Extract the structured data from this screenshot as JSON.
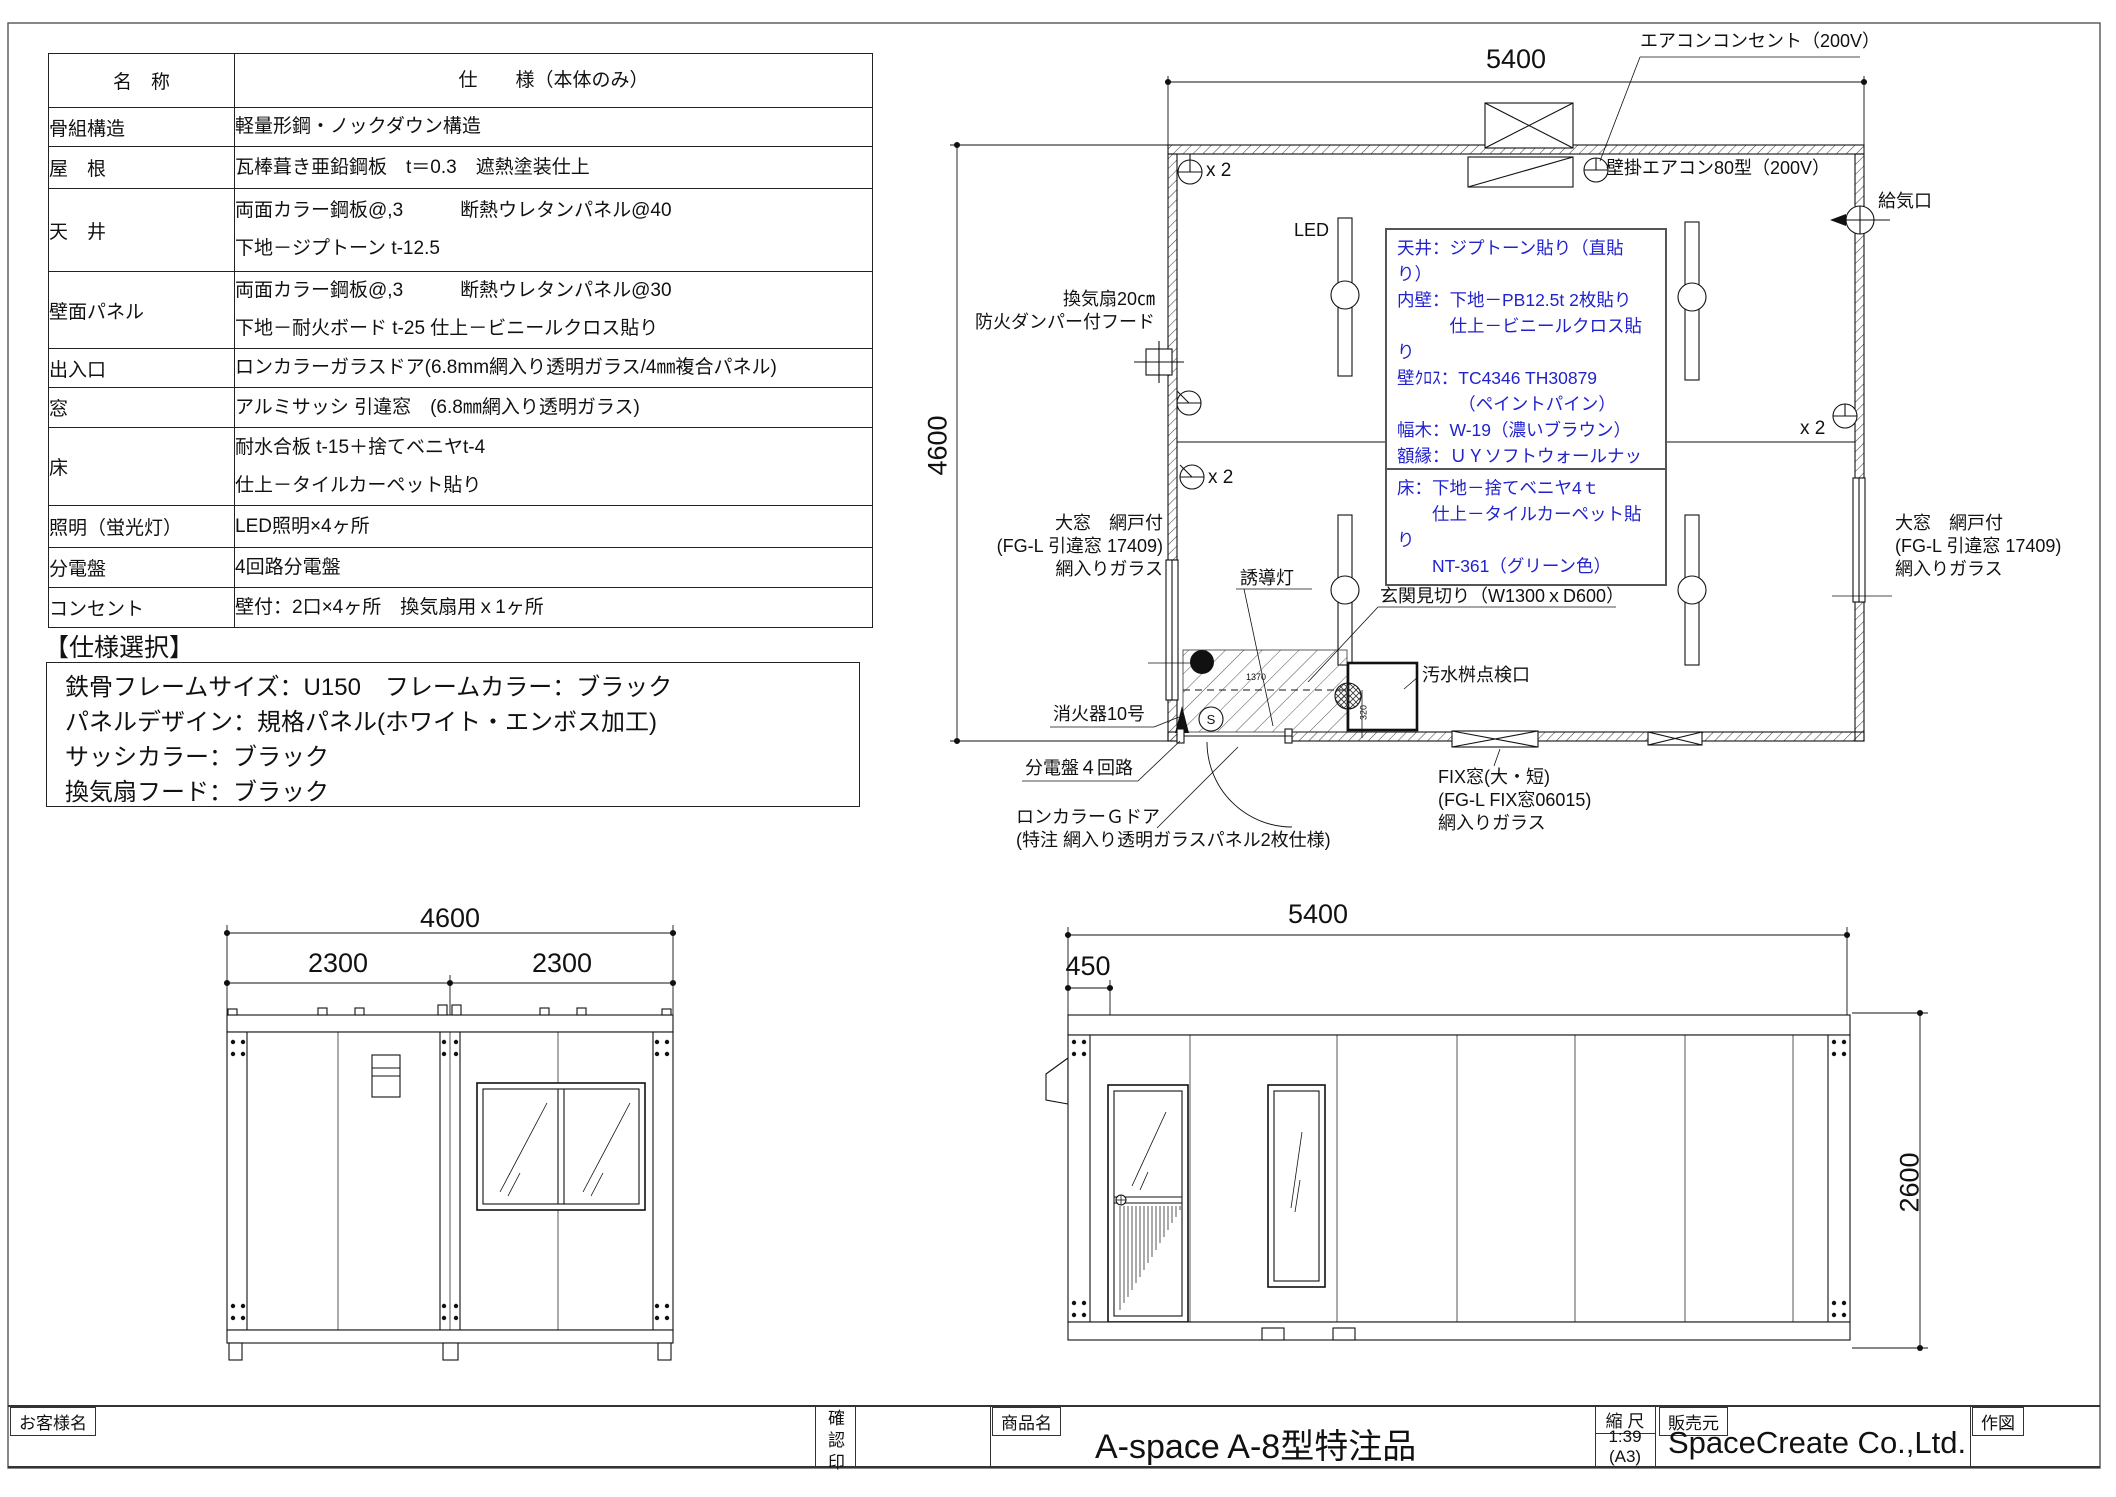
{
  "sheet": {
    "accent_blue": "#2222cc",
    "line_color": "#1a1a1a"
  },
  "spec_table": {
    "title_name": "名　称",
    "title_spec": "仕　　様（本体のみ）",
    "rows": [
      {
        "name": "骨組構造",
        "spec": "軽量形鋼・ノックダウン構造"
      },
      {
        "name": "屋　根",
        "spec": "瓦棒葺き亜鉛鋼板　t＝0.3　遮熱塗装仕上"
      },
      {
        "name": "天　井",
        "spec": "両面カラー鋼板@,3　　　断熱ウレタンパネル@40\n下地－ジプトーン t-12.5"
      },
      {
        "name": "壁面パネル",
        "spec": "両面カラー鋼板@,3　　　断熱ウレタンパネル@30\n下地－耐火ボード t-25  仕上－ビニールクロス貼り"
      },
      {
        "name": "出入口",
        "spec": "ロンカラーガラスドア(6.8mm網入り透明ガラス/4㎜複合パネル)"
      },
      {
        "name": "窓",
        "spec": "アルミサッシ 引違窓　(6.8㎜網入り透明ガラス)"
      },
      {
        "name": "床",
        "spec": "耐水合板 t-15＋捨てベニヤt-4\n仕上－タイルカーペット貼り"
      },
      {
        "name": "照明（蛍光灯）",
        "spec": "LED照明×4ヶ所"
      },
      {
        "name": "分電盤",
        "spec": "4回路分電盤"
      },
      {
        "name": "コンセント",
        "spec": "壁付：2口×4ヶ所　換気扇用ｘ1ヶ所"
      }
    ]
  },
  "selection": {
    "heading": "【仕様選択】",
    "line1": "鉄骨フレームサイズ：U150　フレームカラー：ブラック",
    "line2": "パネルデザイン：規格パネル(ホワイト・エンボス加工)",
    "line3": "サッシカラー：ブラック",
    "line4": "換気扇フード：ブラック"
  },
  "plan": {
    "dim_width": "5400",
    "dim_height": "4600",
    "aircon_outlet": "エアコンコンセント（200V）",
    "wall_aircon": "壁掛エアコン80型（200V）",
    "air_inlet": "給気口",
    "led_label": "LED",
    "fan_note": "換気扇20㎝\n防火ダンパー付フード",
    "outlet_x2": "x 2",
    "finish_note_upper": "天井：ジプトーン貼り（直貼り）\n内壁：下地－PB12.5t 2枚貼り\n　　　仕上－ビニールクロス貼り\n壁ｸﾛｽ：TC4346 TH30879\n　　　　（ペイントパイン）\n幅木：W-19（濃いブラウン）\n額縁：ＵＹソフトウォールナット柄",
    "finish_note_floor": "床：下地－捨てベニヤ4ｔ\n　　仕上－タイルカーペット貼り\n　　NT-361（グリーン色）",
    "window_note": "大窓　網戸付\n(FG-L 引違窓 17409)\n網入りガラス",
    "exit_light": "誘導灯",
    "entrance_note": "玄関見切り（W1300ｘD600）",
    "drain_note": "汚水桝点検口",
    "extinguisher": "消火器10号",
    "panel_note": "分電盤４回路",
    "door_note": "ロンカラーＧドア\n(特注 網入り透明ガラスパネル2枚仕様)",
    "fix_note": "FIX窓(大・短)\n(FG-L FIX窓06015)\n網入りガラス",
    "dim_entry": "1370",
    "dim_drain": "320",
    "s_mark": "S"
  },
  "elev_side": {
    "dim_total": "4600",
    "dim_left": "2300",
    "dim_right": "2300"
  },
  "elev_front": {
    "dim_total": "5400",
    "dim_offset": "450",
    "dim_height": "2600"
  },
  "title_block": {
    "customer_label": "お客様名",
    "confirm_label": "確認印",
    "product_label": "商品名",
    "product_name": "A-space A-8型特注品",
    "scale_label": "縮 尺",
    "scale_value": "1:39",
    "scale_paper": "(A3)",
    "seller_label": "販売元",
    "seller_name": "SpaceCreate Co.,Ltd.",
    "drawn_label": "作図"
  }
}
